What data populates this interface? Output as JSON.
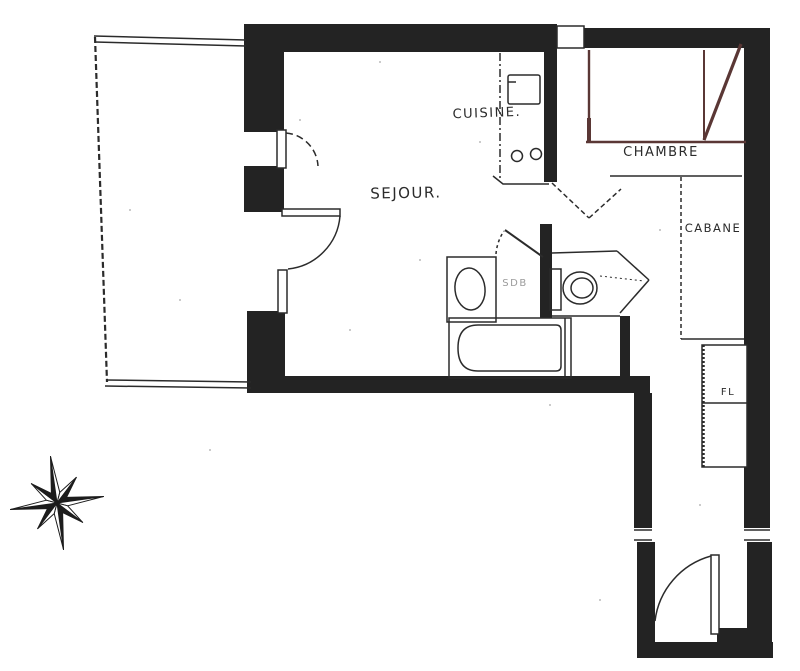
{
  "plan": {
    "labels": {
      "living_room": "SEJOUR.",
      "kitchen": "CUISINE.",
      "bedroom": "CHAMBRE",
      "cabin_closet": "CABANE",
      "bathroom": "SDB",
      "cupboard": "FL"
    },
    "colors": {
      "paper": "#ffffff",
      "ink": "#2b2b2b",
      "wall_fill": "#232323",
      "accent_line": "#5a3735",
      "faint_ink": "#9b9b9b"
    },
    "icons": {
      "compass_rose": "8-point-star"
    }
  }
}
